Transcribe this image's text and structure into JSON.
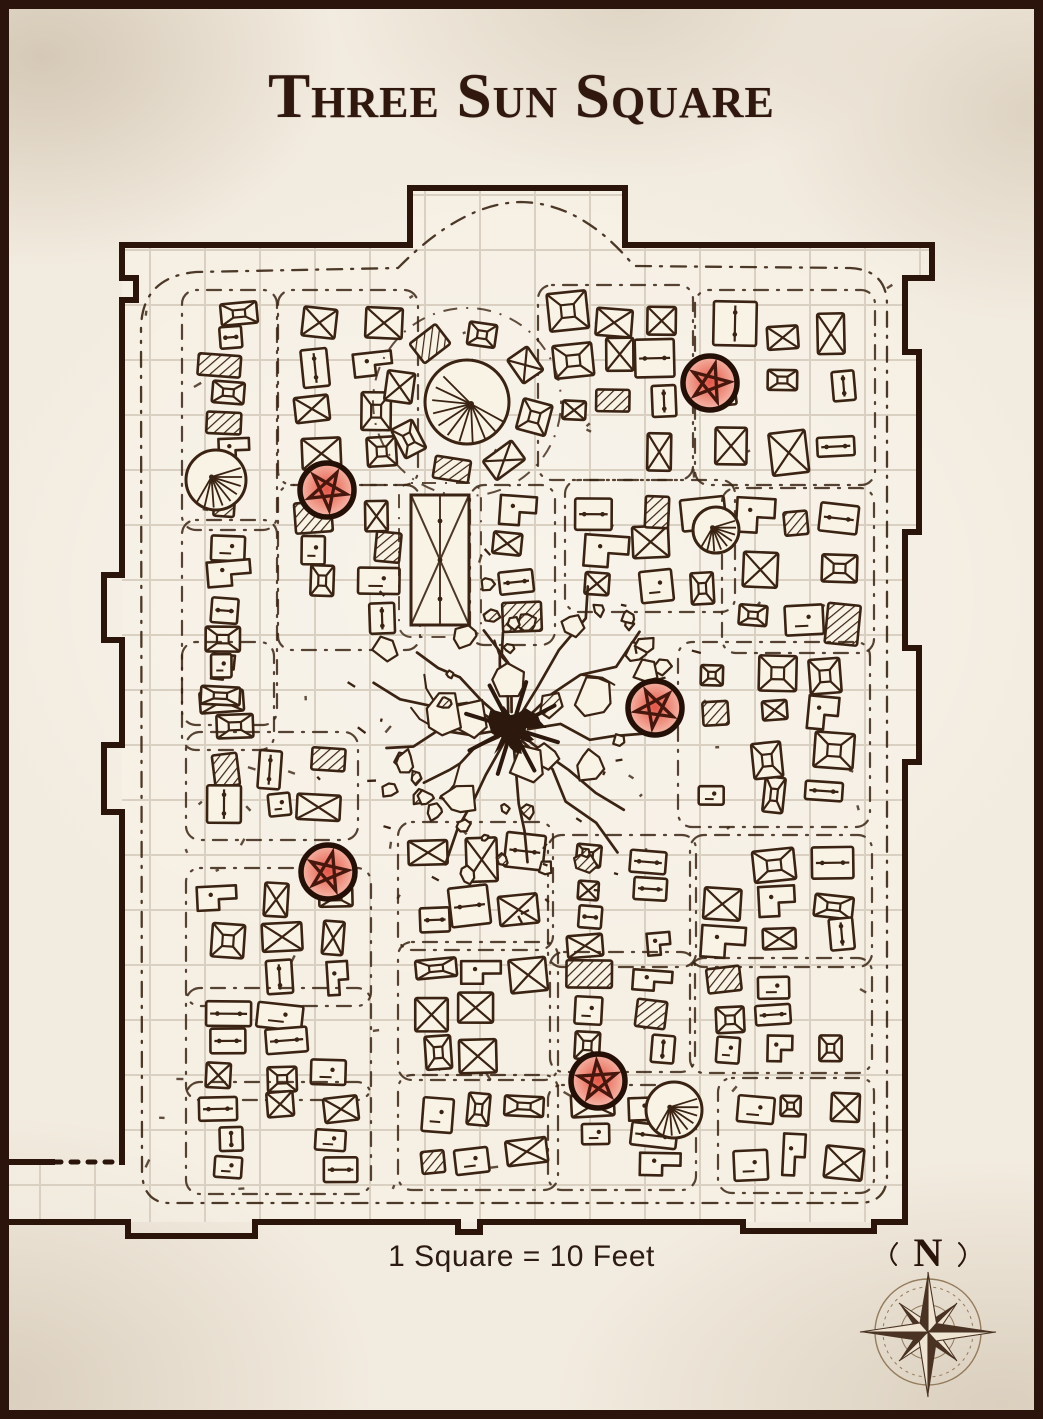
{
  "title": "Three Sun Square",
  "scale_label": "1 Square = 10 Feet",
  "compass": {
    "north_label": "N"
  },
  "palette": {
    "ink": "#3a2312",
    "wall": "#2b1409",
    "grid": "#d9d0c2",
    "paper": "#f2ebdf",
    "interior": "#f8f2e7",
    "stall_fill": "#f9f3e6",
    "marker_center": "#e25648",
    "marker_mid": "#ef9181",
    "marker_edge": "#f6c0b2",
    "marker_ring": "#241006",
    "pentagram": "#47160c",
    "compass_dark": "#4a3322",
    "compass_light": "#efe5d2",
    "compass_line": "#937b5c"
  },
  "map": {
    "grid": {
      "size": 55,
      "offset_x": 40,
      "offset_y": 30,
      "unit_feet": 10
    },
    "markers": [
      {
        "id": 1,
        "x": 710,
        "y": 383
      },
      {
        "id": 2,
        "x": 327,
        "y": 490
      },
      {
        "id": 3,
        "x": 655,
        "y": 708
      },
      {
        "id": 4,
        "x": 328,
        "y": 872
      },
      {
        "id": 5,
        "x": 598,
        "y": 1081
      }
    ],
    "crater": {
      "x": 512,
      "y": 728,
      "core_r": 34,
      "debris_r": 175,
      "cracks": 13
    },
    "clusters": [
      {
        "x": 192,
        "y": 300,
        "w": 75,
        "h": 220,
        "n": 8
      },
      {
        "x": 288,
        "y": 300,
        "w": 120,
        "h": 175,
        "n": 8
      },
      {
        "x": 548,
        "y": 295,
        "w": 135,
        "h": 175,
        "n": 10
      },
      {
        "x": 705,
        "y": 300,
        "w": 160,
        "h": 175,
        "n": 9
      },
      {
        "x": 192,
        "y": 530,
        "w": 75,
        "h": 185,
        "n": 6
      },
      {
        "x": 288,
        "y": 495,
        "w": 122,
        "h": 145,
        "n": 7
      },
      {
        "x": 480,
        "y": 495,
        "w": 65,
        "h": 140,
        "n": 4
      },
      {
        "x": 575,
        "y": 490,
        "w": 150,
        "h": 112,
        "n": 8
      },
      {
        "x": 732,
        "y": 498,
        "w": 132,
        "h": 145,
        "n": 8
      },
      {
        "x": 192,
        "y": 652,
        "w": 72,
        "h": 88,
        "n": 3
      },
      {
        "x": 196,
        "y": 742,
        "w": 152,
        "h": 88,
        "n": 6
      },
      {
        "x": 688,
        "y": 652,
        "w": 172,
        "h": 165,
        "n": 11
      },
      {
        "x": 196,
        "y": 878,
        "w": 165,
        "h": 118,
        "n": 8
      },
      {
        "x": 408,
        "y": 832,
        "w": 135,
        "h": 108,
        "n": 6
      },
      {
        "x": 558,
        "y": 845,
        "w": 128,
        "h": 112,
        "n": 7
      },
      {
        "x": 700,
        "y": 845,
        "w": 162,
        "h": 112,
        "n": 8
      },
      {
        "x": 196,
        "y": 998,
        "w": 165,
        "h": 92,
        "n": 7
      },
      {
        "x": 408,
        "y": 952,
        "w": 140,
        "h": 118,
        "n": 7
      },
      {
        "x": 560,
        "y": 962,
        "w": 125,
        "h": 100,
        "n": 6
      },
      {
        "x": 700,
        "y": 968,
        "w": 162,
        "h": 95,
        "n": 7
      },
      {
        "x": 196,
        "y": 1092,
        "w": 165,
        "h": 92,
        "n": 7
      },
      {
        "x": 408,
        "y": 1085,
        "w": 140,
        "h": 95,
        "n": 6
      },
      {
        "x": 558,
        "y": 1095,
        "w": 128,
        "h": 85,
        "n": 5
      },
      {
        "x": 728,
        "y": 1088,
        "w": 136,
        "h": 95,
        "n": 6
      }
    ],
    "specials": [
      {
        "type": "plaza",
        "x": 467,
        "y": 402,
        "r": 42
      },
      {
        "type": "hall",
        "x": 440,
        "y": 560,
        "w": 58,
        "h": 130
      },
      {
        "type": "fan",
        "x": 216,
        "y": 480,
        "r": 30
      },
      {
        "type": "fan",
        "x": 716,
        "y": 530,
        "r": 23
      },
      {
        "type": "fan",
        "x": 674,
        "y": 1110,
        "r": 28
      }
    ]
  }
}
